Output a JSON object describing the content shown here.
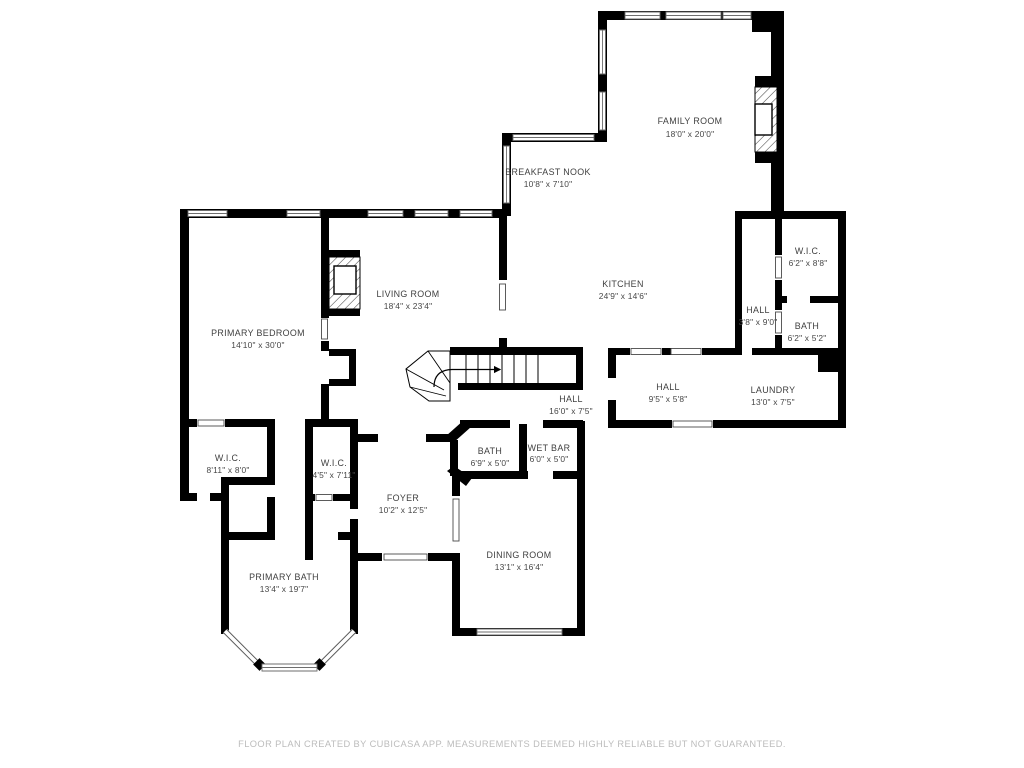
{
  "page": {
    "footer": "FLOOR PLAN CREATED BY CUBICASA APP. MEASUREMENTS DEEMED HIGHLY RELIABLE BUT NOT GUARANTEED."
  },
  "colors": {
    "wall": "#000000",
    "room_text": "#3f3f3f",
    "footer_text": "#bcbcbc",
    "window_line": "#6e6e6e",
    "background": "#ffffff"
  },
  "icons": {
    "fireplace": "fireplace-icon (hatched box with firebox)",
    "staircase": "staircase-icon (treads with direction arrow)",
    "window": "window-icon (double line in wall)",
    "bay_window": "bay-window-icon (angled window walls)"
  },
  "rooms": {
    "family_room": {
      "name": "FAMILY ROOM",
      "dims": "18'0\" x 20'0\""
    },
    "breakfast_nook": {
      "name": "BREAKFAST NOOK",
      "dims": "10'8\" x 7'10\""
    },
    "kitchen": {
      "name": "KITCHEN",
      "dims": "24'9\" x 14'6\""
    },
    "living_room": {
      "name": "LIVING ROOM",
      "dims": "18'4\" x 23'4\""
    },
    "primary_bedroom": {
      "name": "PRIMARY BEDROOM",
      "dims": "14'10\" x 30'0\""
    },
    "wic_upper_right": {
      "name": "W.I.C.",
      "dims": "6'2\" x 8'8\""
    },
    "hall_right": {
      "name": "HALL",
      "dims": "3'8\" x 9'0\""
    },
    "bath_right": {
      "name": "BATH",
      "dims": "6'2\" x 5'2\""
    },
    "hall_center_small": {
      "name": "HALL",
      "dims": "9'5\" x 5'8\""
    },
    "laundry": {
      "name": "LAUNDRY",
      "dims": "13'0\" x 7'5\""
    },
    "hall_main": {
      "name": "HALL",
      "dims": "16'0\" x 7'5\""
    },
    "bath_center": {
      "name": "BATH",
      "dims": "6'9\" x 5'0\""
    },
    "wet_bar": {
      "name": "WET BAR",
      "dims": "6'0\" x 5'0\""
    },
    "foyer": {
      "name": "FOYER",
      "dims": "10'2\" x 12'5\""
    },
    "dining_room": {
      "name": "DINING ROOM",
      "dims": "13'1\" x 16'4\""
    },
    "wic_left": {
      "name": "W.I.C.",
      "dims": "8'11\" x 8'0\""
    },
    "wic_center": {
      "name": "W.I.C.",
      "dims": "4'5\" x 7'11\""
    },
    "primary_bath": {
      "name": "PRIMARY BATH",
      "dims": "13'4\" x 19'7\""
    }
  }
}
